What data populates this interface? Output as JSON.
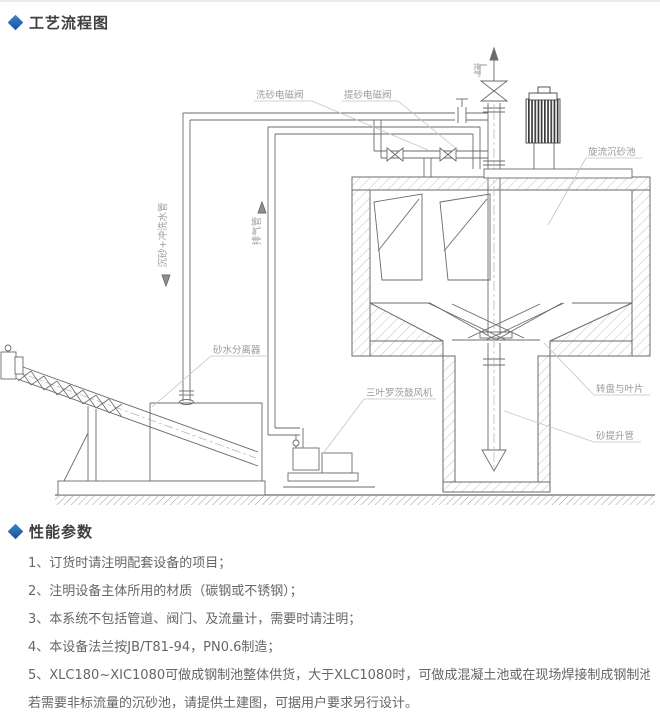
{
  "colors": {
    "accent": "#2a6fba",
    "line": "#6b6b6b",
    "label": "#9a9a9a"
  },
  "sections": {
    "flow": {
      "title": "工艺流程图"
    },
    "perf": {
      "title": "性能参数"
    }
  },
  "diagram": {
    "labels": {
      "wash_valve": "洗砂电磁阀",
      "lift_valve": "提砂电磁阀",
      "cyclone_tank": "旋流沉砂池",
      "exhaust_top": "排气",
      "sand_flush_pipe": "沉砂+冲洗水管",
      "exhaust_pipe": "排气管",
      "separator": "砂水分离器",
      "blower": "三叶罗茨鼓风机",
      "turntable": "转盘与叶片",
      "sand_lift_pipe": "砂提升管"
    }
  },
  "notes": {
    "items": [
      {
        "num": "1、",
        "text": "订货时请注明配套设备的项目；"
      },
      {
        "num": "2、",
        "text": "注明设备主体所用的材质（碳钢或不锈钢）；"
      },
      {
        "num": "3、",
        "text": "本系统不包括管道、阀门、及流量计，需要时请注明；"
      },
      {
        "num": "4、",
        "text": "本设备法兰按JB/T81-94，PN0.6制造；"
      },
      {
        "num": "5、",
        "text": "XLC180~XIC1080可做成钢制池整体供货，大于XLC1080时，可做成混凝土池或在现场焊接制成钢制池；"
      },
      {
        "num": "",
        "text": "若需要非标流量的沉砂池，请提供土建图，可据用户要求另行设计。"
      }
    ]
  }
}
